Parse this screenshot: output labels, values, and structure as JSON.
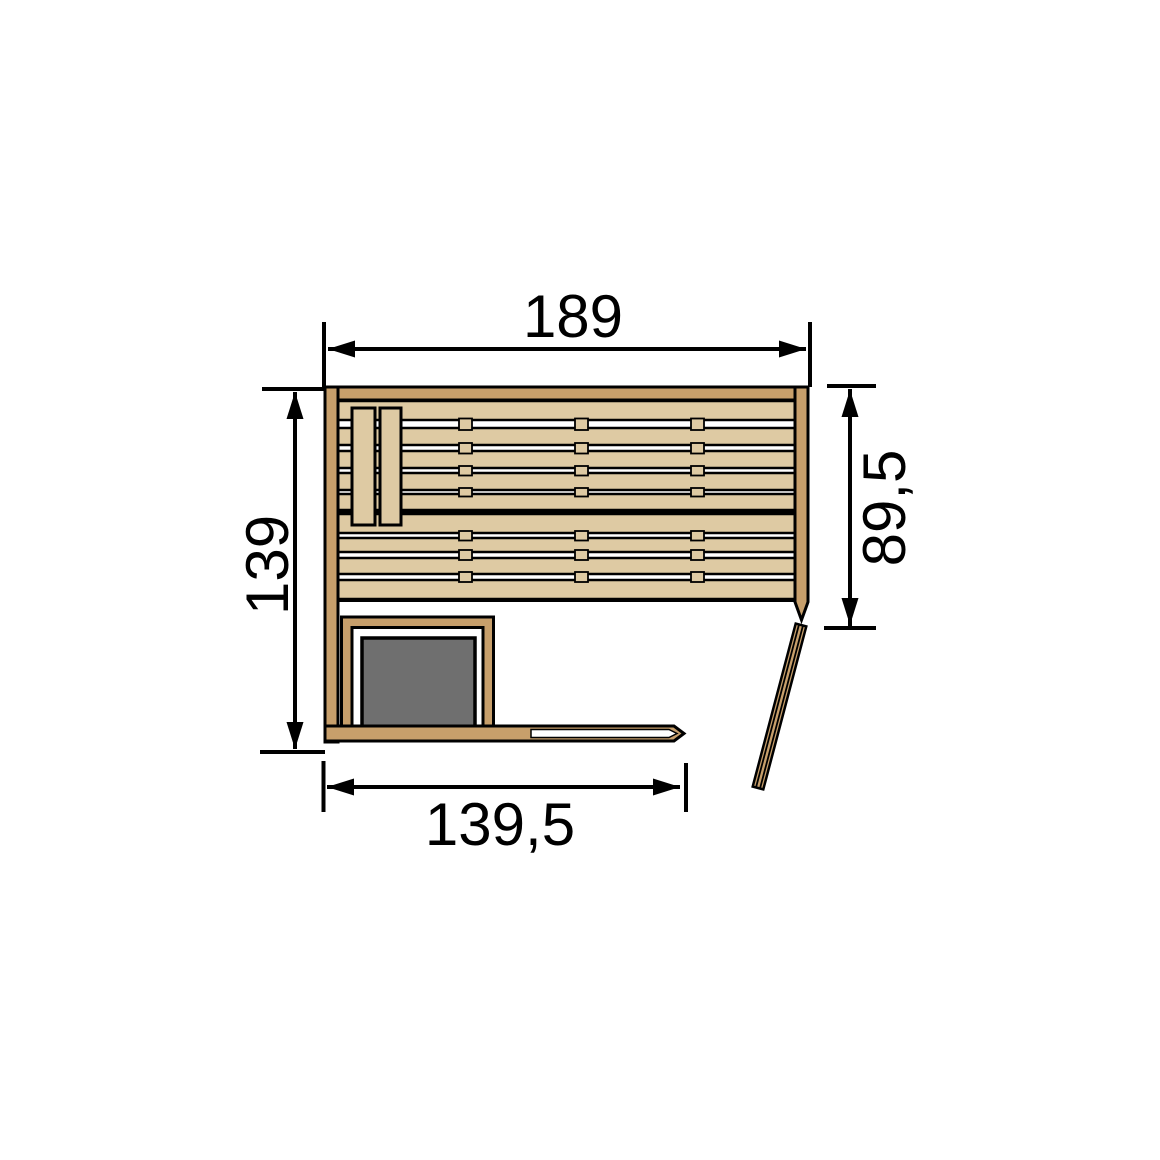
{
  "page": {
    "background": "#ffffff"
  },
  "diagram": {
    "kind": "sauna-floor-plan",
    "dimension_labels": {
      "top_width": "189",
      "left_depth": "139",
      "right_bench_depth": "89,5",
      "bottom_front_width": "139,5"
    },
    "colors": {
      "wall_wood": "#c79f6b",
      "bench_wood": "#decaa3",
      "heater_gray": "#6f6f6f",
      "line_black": "#000000",
      "background": "#ffffff"
    }
  }
}
